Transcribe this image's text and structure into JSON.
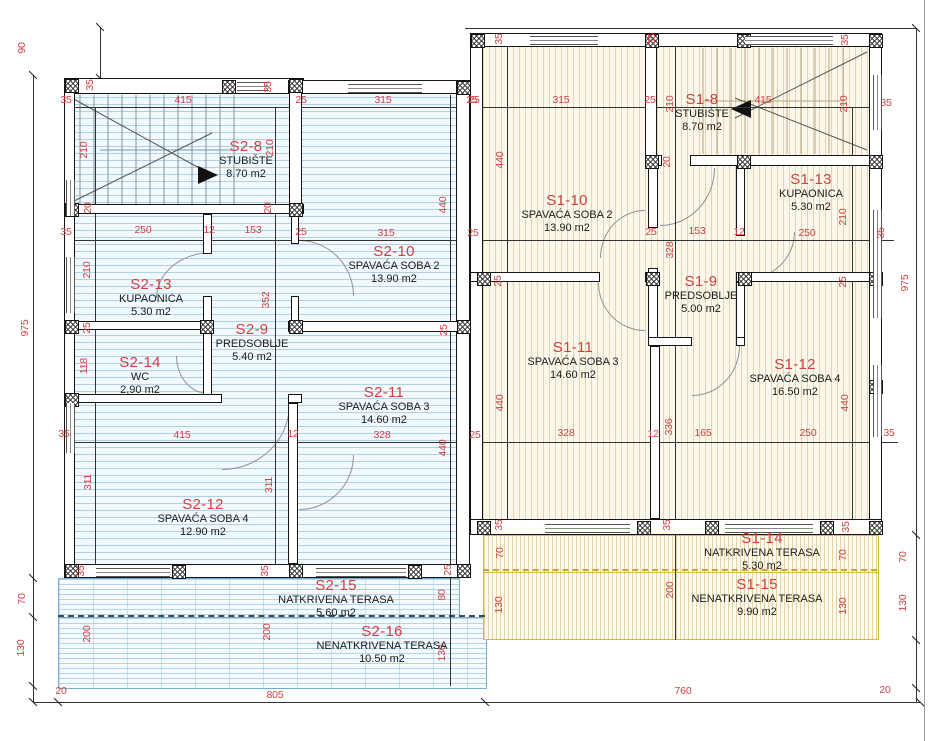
{
  "drawing_title": "floor plan",
  "colors": {
    "dimension_red": "#cf4040",
    "wall_black": "#141414",
    "s2_hatch_blue": "#78afd2",
    "s1_hatch_cream": "#d8c98f",
    "terrace_yellow": "#d9b94c",
    "door_arc_gray": "#909090"
  },
  "rooms": [
    {
      "id": "S2-8",
      "name": "STUBIŠTE",
      "area": "8.70 m2",
      "x": 246,
      "y": 138
    },
    {
      "id": "S2-10",
      "name": "SPAVAĆA SOBA 2",
      "area": "13.90 m2",
      "x": 394,
      "y": 243
    },
    {
      "id": "S2-13",
      "name": "KUPAONICA",
      "area": "5.30 m2",
      "x": 151,
      "y": 276
    },
    {
      "id": "S2-9",
      "name": "PREDSOBLJE",
      "area": "5.40 m2",
      "x": 252,
      "y": 321
    },
    {
      "id": "S2-14",
      "name": "WC",
      "area": "2,90 m2",
      "x": 140,
      "y": 354
    },
    {
      "id": "S2-11",
      "name": "SPAVAĆA SOBA 3",
      "area": "14.60 m2",
      "x": 384,
      "y": 384
    },
    {
      "id": "S2-12",
      "name": "SPAVAĆA SOBA 4",
      "area": "12.90 m2",
      "x": 203,
      "y": 496
    },
    {
      "id": "S2-15",
      "name": "NATKRIVENA TERASA",
      "area": "5.60 m2",
      "x": 336,
      "y": 577
    },
    {
      "id": "S2-16",
      "name": "NENATKRIVENA TERASA",
      "area": "10.50 m2",
      "x": 382,
      "y": 623
    },
    {
      "id": "S1-10",
      "name": "SPAVAĆA SOBA 2",
      "area": "13.90 m2",
      "x": 567,
      "y": 192
    },
    {
      "id": "S1-8",
      "name": "STUBIŠTE",
      "area": "8.70 m2",
      "x": 702,
      "y": 91
    },
    {
      "id": "S1-13",
      "name": "KUPAONICA",
      "area": "5.30 m2",
      "x": 811,
      "y": 171
    },
    {
      "id": "S1-9",
      "name": "PREDSOBLJE",
      "area": "5.00 m2",
      "x": 701,
      "y": 273
    },
    {
      "id": "S1-11",
      "name": "SPAVAĆA SOBA 3",
      "area": "14.60 m2",
      "x": 573,
      "y": 339
    },
    {
      "id": "S1-12",
      "name": "SPAVAĆA SOBA 4",
      "area": "16.50 m2",
      "x": 795,
      "y": 356
    },
    {
      "id": "S1-14",
      "name": "NATKRIVENA TERASA",
      "area": "5.30 m2",
      "x": 762,
      "y": 530
    },
    {
      "id": "S1-15",
      "name": "NENATKRIVENA TERASA",
      "area": "9.90 m2",
      "x": 757,
      "y": 576
    }
  ],
  "dimensions": [
    [
      "90",
      22,
      48,
      1
    ],
    [
      "975",
      25,
      328,
      1
    ],
    [
      "35",
      66,
      100,
      0
    ],
    [
      "415",
      183,
      100,
      0
    ],
    [
      "35",
      90,
      85,
      1
    ],
    [
      "35",
      268,
      87,
      1
    ],
    [
      "25",
      301,
      100,
      0
    ],
    [
      "315",
      383,
      100,
      0
    ],
    [
      "25",
      472,
      100,
      0
    ],
    [
      "210",
      84,
      150,
      1
    ],
    [
      "210",
      270,
      148,
      1
    ],
    [
      "20",
      88,
      208,
      1
    ],
    [
      "20",
      268,
      208,
      1
    ],
    [
      "35",
      66,
      232,
      0
    ],
    [
      "250",
      143,
      230,
      0
    ],
    [
      "12",
      209,
      230,
      0
    ],
    [
      "153",
      253,
      230,
      0
    ],
    [
      "25",
      301,
      232,
      0
    ],
    [
      "315",
      386,
      233,
      0
    ],
    [
      "25",
      473,
      233,
      0
    ],
    [
      "210",
      87,
      270,
      1
    ],
    [
      "352",
      266,
      300,
      1
    ],
    [
      "25",
      87,
      328,
      1
    ],
    [
      "118",
      84,
      366,
      1
    ],
    [
      "35",
      64,
      434,
      0
    ],
    [
      "415",
      182,
      435,
      0
    ],
    [
      "12",
      293,
      434,
      0
    ],
    [
      "440",
      443,
      205,
      1
    ],
    [
      "25",
      444,
      330,
      1
    ],
    [
      "440",
      443,
      448,
      1
    ],
    [
      "328",
      382,
      435,
      0
    ],
    [
      "25",
      475,
      435,
      0
    ],
    [
      "311",
      88,
      482,
      1
    ],
    [
      "311",
      269,
      485,
      1
    ],
    [
      "35",
      81,
      571,
      1
    ],
    [
      "35",
      265,
      571,
      1
    ],
    [
      "25",
      448,
      570,
      1
    ],
    [
      "80",
      442,
      595,
      1
    ],
    [
      "200",
      87,
      634,
      1
    ],
    [
      "200",
      267,
      632,
      1
    ],
    [
      "130",
      442,
      653,
      1
    ],
    [
      "70",
      22,
      599,
      1
    ],
    [
      "130",
      21,
      648,
      1
    ],
    [
      "20",
      61,
      691,
      0
    ],
    [
      "805",
      275,
      695,
      0
    ],
    [
      "35",
      499,
      39,
      1
    ],
    [
      "35",
      652,
      39,
      1
    ],
    [
      "35",
      845,
      40,
      1
    ],
    [
      "25",
      474,
      100,
      0
    ],
    [
      "315",
      561,
      100,
      0
    ],
    [
      "25",
      650,
      100,
      0
    ],
    [
      "210",
      670,
      104,
      1
    ],
    [
      "415",
      763,
      100,
      0
    ],
    [
      "210",
      844,
      104,
      1
    ],
    [
      "35",
      886,
      103,
      0
    ],
    [
      "440",
      500,
      160,
      1
    ],
    [
      "20",
      667,
      162,
      1
    ],
    [
      "25",
      651,
      232,
      0
    ],
    [
      "153",
      697,
      231,
      0
    ],
    [
      "12",
      739,
      232,
      0
    ],
    [
      "250",
      807,
      233,
      0
    ],
    [
      "35",
      881,
      233,
      1
    ],
    [
      "210",
      843,
      217,
      1
    ],
    [
      "328",
      670,
      250,
      1
    ],
    [
      "975",
      905,
      283,
      1
    ],
    [
      "25",
      498,
      281,
      1
    ],
    [
      "25",
      843,
      282,
      1
    ],
    [
      "440",
      500,
      403,
      1
    ],
    [
      "440",
      845,
      403,
      1
    ],
    [
      "328",
      566,
      433,
      0
    ],
    [
      "12",
      653,
      434,
      0
    ],
    [
      "336",
      669,
      427,
      1
    ],
    [
      "165",
      703,
      433,
      0
    ],
    [
      "250",
      808,
      433,
      0
    ],
    [
      "35",
      889,
      433,
      0
    ],
    [
      "35",
      499,
      525,
      1
    ],
    [
      "35",
      667,
      525,
      1
    ],
    [
      "35",
      846,
      527,
      1
    ],
    [
      "70",
      500,
      553,
      1
    ],
    [
      "70",
      843,
      555,
      1
    ],
    [
      "70",
      903,
      557,
      1
    ],
    [
      "200",
      670,
      590,
      1
    ],
    [
      "130",
      499,
      605,
      1
    ],
    [
      "130",
      843,
      606,
      1
    ],
    [
      "130",
      903,
      603,
      1
    ],
    [
      "760",
      683,
      691,
      0
    ],
    [
      "20",
      885,
      690,
      0
    ]
  ]
}
